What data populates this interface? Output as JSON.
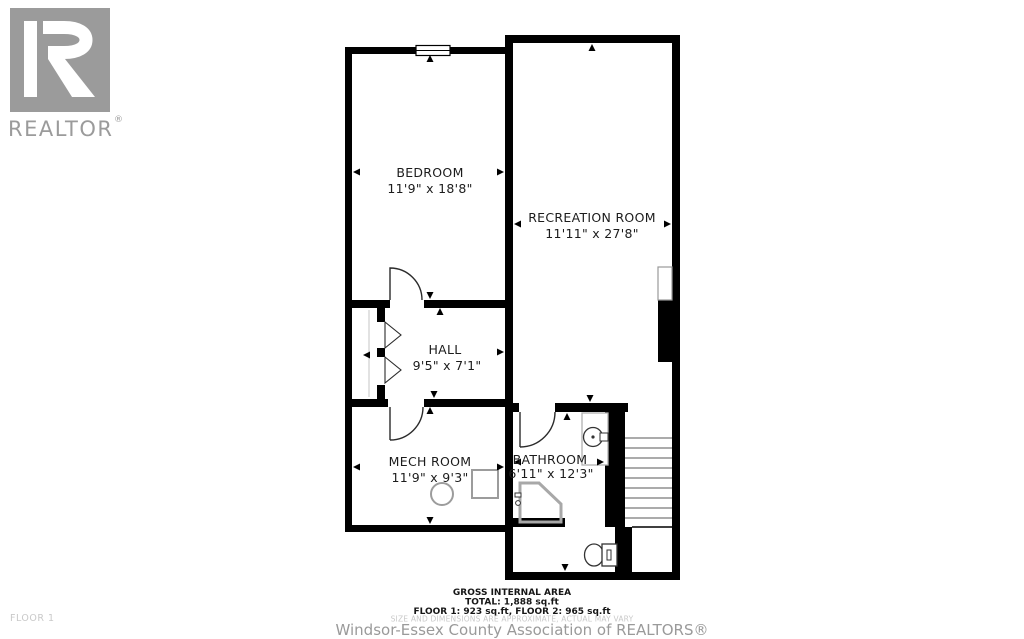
{
  "branding": {
    "logo_text": "REALTOR",
    "registered_mark": "®",
    "logo_color": "#9b9b9b"
  },
  "plan": {
    "floor_label": "FLOOR 1",
    "rooms": [
      {
        "name": "BEDROOM",
        "dims": "11'9\" x 18'8\""
      },
      {
        "name": "RECREATION ROOM",
        "dims": "11'11\" x 27'8\""
      },
      {
        "name": "HALL",
        "dims": "9'5\" x 7'1\""
      },
      {
        "name": "MECH ROOM",
        "dims": "11'9\" x 9'3\""
      },
      {
        "name": "BATHROOM",
        "dims": "6'11\" x 12'3\""
      }
    ],
    "fixture_icons": [
      "window-icon",
      "door-swing-icon",
      "bifold-closet-door-icon",
      "stairs-icon",
      "fireplace-icon",
      "water-tank-icon",
      "furnace-icon",
      "sink-icon",
      "shower-icon",
      "toilet-icon"
    ]
  },
  "footer": {
    "area_title": "GROSS INTERNAL AREA",
    "total_line": "TOTAL: 1,888 sq.ft",
    "floors_line": "FLOOR 1: 923 sq.ft, FLOOR 2: 965 sq.ft",
    "disclaimer": "SIZE AND DIMENSIONS ARE APPROXIMATE, ACTUAL MAY VARY",
    "attribution": "Windsor-Essex County Association of REALTORS®"
  },
  "colors": {
    "wall": "#000000",
    "background": "#ffffff",
    "fixture": "#9c9c9c",
    "logo": "#9b9b9b",
    "text": "#1c1c1c",
    "muted": "#c9c9c9"
  }
}
